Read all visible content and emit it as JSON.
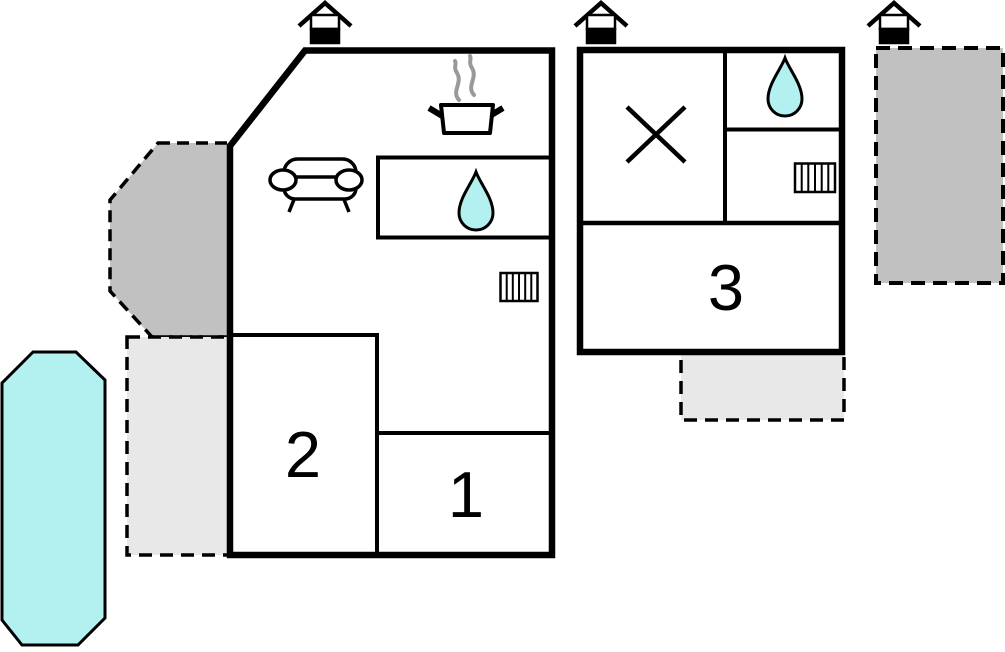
{
  "plan": {
    "type": "vacation-house-floor-plan",
    "rooms": [
      {
        "id": "room1",
        "label": "1"
      },
      {
        "id": "room2",
        "label": "2"
      },
      {
        "id": "room3",
        "label": "3"
      }
    ],
    "colors": {
      "wall": "#000000",
      "water_fill": "#b3f1f1",
      "terrace_dark_fill": "#c1c1c1",
      "terrace_light_fill": "#e8e8e8",
      "steam_stroke": "#999999",
      "background": "#ffffff"
    },
    "icons": [
      {
        "name": "entrance-icon",
        "meaning": "entrance / chimney marker",
        "count": 3
      },
      {
        "name": "sofa-icon",
        "meaning": "living room sofa",
        "count": 1
      },
      {
        "name": "cooking-pot-icon",
        "meaning": "kitchen / stove",
        "count": 1
      },
      {
        "name": "water-drop-icon",
        "meaning": "water / bathroom",
        "count": 2
      },
      {
        "name": "radiator-icon",
        "meaning": "heating radiator",
        "count": 2
      },
      {
        "name": "cross-icon",
        "meaning": "crossed-out area",
        "count": 1
      },
      {
        "name": "pool-shape",
        "meaning": "swimming pool",
        "count": 1
      }
    ]
  }
}
